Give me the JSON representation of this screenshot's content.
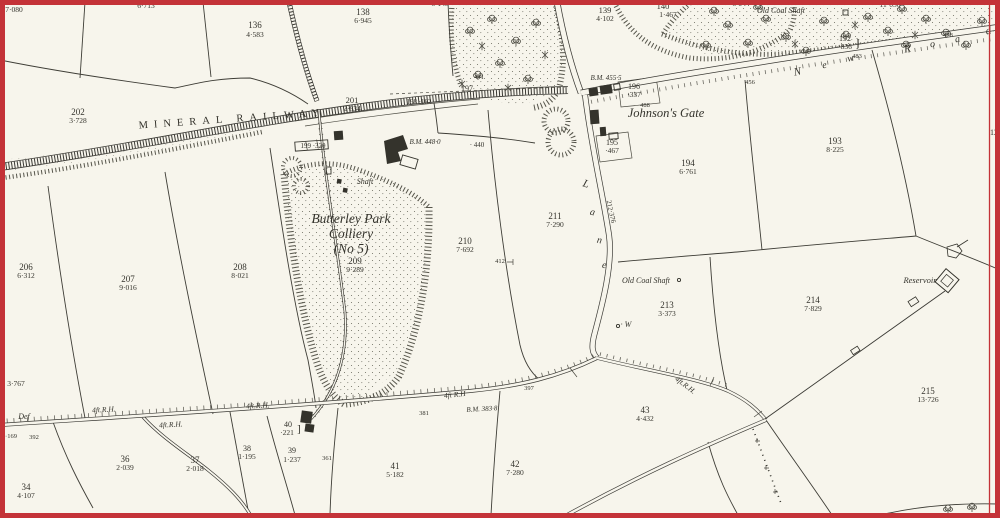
{
  "map": {
    "description": "Historical Ordnance Survey style plan, Butterley Park Colliery area",
    "palette": {
      "paper": "#f7f5ec",
      "ink": "#34332c",
      "frame_red": "#c43338"
    },
    "features": {
      "railway": "Mineral Railway with cross-hatched embankment and sidings",
      "colliery": "Butterley Park Colliery (No 5) with spoil heap and shafts",
      "roads": [
        "New Road",
        "Lane"
      ],
      "water": [
        "Reservoir"
      ],
      "boundary": "red sheet border"
    }
  },
  "labels": [
    {
      "t": "7·080",
      "x": 14,
      "y": 12,
      "s": 7.5,
      "st": "area"
    },
    {
      "t": "6·713",
      "x": 146,
      "y": 8,
      "s": 7.5,
      "st": "area"
    },
    {
      "t": "136",
      "x": 255,
      "y": 28,
      "s": 9,
      "st": "num"
    },
    {
      "t": "4·583",
      "x": 255,
      "y": 37,
      "s": 7.5,
      "st": "area"
    },
    {
      "t": "138",
      "x": 363,
      "y": 15,
      "s": 9,
      "st": "num"
    },
    {
      "t": "6·945",
      "x": 363,
      "y": 23,
      "s": 7.5,
      "st": "area"
    },
    {
      "t": "6·148",
      "x": 440,
      "y": 6,
      "s": 7.5,
      "st": "area"
    },
    {
      "t": "139",
      "x": 605,
      "y": 13,
      "s": 8.5,
      "st": "num"
    },
    {
      "t": "4·102",
      "x": 605,
      "y": 21,
      "s": 7.5,
      "st": "area"
    },
    {
      "t": "140",
      "x": 663,
      "y": 9,
      "s": 8.5,
      "st": "num"
    },
    {
      "t": "1·467",
      "x": 668,
      "y": 17,
      "s": 7.5,
      "st": "area"
    },
    {
      "t": "6·944",
      "x": 741,
      "y": 6,
      "s": 7.5,
      "st": "area"
    },
    {
      "t": "Old Coal Shaft",
      "x": 781,
      "y": 13,
      "s": 8,
      "st": "it"
    },
    {
      "t": "11·050",
      "x": 890,
      "y": 7,
      "s": 7.5,
      "st": "area"
    },
    {
      "t": "192",
      "x": 845,
      "y": 41,
      "s": 8,
      "st": "num"
    },
    {
      "t": "·836",
      "x": 845,
      "y": 49,
      "s": 7.5,
      "st": "area"
    },
    {
      "t": "}",
      "x": 858,
      "y": 47,
      "s": 13,
      "st": "num"
    },
    {
      "t": "478",
      "x": 948,
      "y": 37,
      "s": 6.5,
      "st": "tiny"
    },
    {
      "t": "N",
      "x": 798,
      "y": 75,
      "s": 11,
      "st": "it",
      "r": -10
    },
    {
      "t": "e",
      "x": 825,
      "y": 68,
      "s": 10,
      "st": "it",
      "r": -10
    },
    {
      "t": "w",
      "x": 851,
      "y": 61,
      "s": 10,
      "st": "it",
      "r": -10
    },
    {
      "t": "R",
      "x": 908,
      "y": 52,
      "s": 11,
      "st": "it",
      "r": -10
    },
    {
      "t": "o",
      "x": 933,
      "y": 47,
      "s": 10,
      "st": "it",
      "r": -10
    },
    {
      "t": "a",
      "x": 958,
      "y": 42,
      "s": 10,
      "st": "it",
      "r": -10
    },
    {
      "t": "d",
      "x": 989,
      "y": 34,
      "s": 11,
      "st": "it",
      "r": -10
    },
    {
      "t": "456",
      "x": 750,
      "y": 84,
      "s": 6.5,
      "st": "tiny"
    },
    {
      "t": "483",
      "x": 857,
      "y": 58,
      "s": 6.5,
      "st": "tiny"
    },
    {
      "t": "441",
      "x": 479,
      "y": 79,
      "s": 6.5,
      "st": "tiny"
    },
    {
      "t": "197",
      "x": 467,
      "y": 91,
      "s": 8,
      "st": "num"
    },
    {
      "t": "198 ·182",
      "x": 419,
      "y": 104,
      "s": 7,
      "st": "tiny"
    },
    {
      "t": "B.M. 455·5",
      "x": 606,
      "y": 80,
      "s": 7,
      "st": "bm"
    },
    {
      "t": "196",
      "x": 634,
      "y": 89,
      "s": 8,
      "st": "num"
    },
    {
      "t": "·337",
      "x": 634,
      "y": 97,
      "s": 7.5,
      "st": "area"
    },
    {
      "t": "488",
      "x": 645,
      "y": 107,
      "s": 6.5,
      "st": "tiny"
    },
    {
      "t": "Johnson's Gate",
      "x": 666,
      "y": 117,
      "s": 12.5,
      "st": "it"
    },
    {
      "t": "195",
      "x": 612,
      "y": 145,
      "s": 8,
      "st": "num"
    },
    {
      "t": "·467",
      "x": 612,
      "y": 153,
      "s": 7.5,
      "st": "area"
    },
    {
      "t": "12",
      "x": 994,
      "y": 135,
      "s": 8,
      "st": "num"
    },
    {
      "t": "193",
      "x": 835,
      "y": 144,
      "s": 9,
      "st": "num"
    },
    {
      "t": "8·225",
      "x": 835,
      "y": 152,
      "s": 7.5,
      "st": "area"
    },
    {
      "t": "194",
      "x": 688,
      "y": 166,
      "s": 9,
      "st": "num"
    },
    {
      "t": "6·761",
      "x": 688,
      "y": 174,
      "s": 7.5,
      "st": "area"
    },
    {
      "t": "MINERAL  RAILWAY",
      "x": 232,
      "y": 122,
      "s": 10.5,
      "st": "caps",
      "r": -4
    },
    {
      "t": "202",
      "x": 78,
      "y": 115,
      "s": 9,
      "st": "num"
    },
    {
      "t": "3·728",
      "x": 78,
      "y": 123,
      "s": 7.5,
      "st": "area"
    },
    {
      "t": "201",
      "x": 352,
      "y": 103,
      "s": 8.5,
      "st": "num"
    },
    {
      "t": "2·834",
      "x": 352,
      "y": 111,
      "s": 7.5,
      "st": "area"
    },
    {
      "t": "199 ·320",
      "x": 313,
      "y": 148,
      "s": 7,
      "st": "tiny"
    },
    {
      "t": "B.M. 448·0",
      "x": 425,
      "y": 144,
      "s": 7,
      "st": "bm"
    },
    {
      "t": "· 440",
      "x": 477,
      "y": 147,
      "s": 7,
      "st": "tiny"
    },
    {
      "t": "Shaft",
      "x": 365,
      "y": 184,
      "s": 8,
      "st": "it"
    },
    {
      "t": "Butterley Park",
      "x": 351,
      "y": 223,
      "s": 13.5,
      "st": "it"
    },
    {
      "t": "Colliery",
      "x": 351,
      "y": 238,
      "s": 13.5,
      "st": "it"
    },
    {
      "t": "(No 5)",
      "x": 351,
      "y": 253,
      "s": 13.5,
      "st": "it"
    },
    {
      "t": "209",
      "x": 355,
      "y": 264,
      "s": 9,
      "st": "num"
    },
    {
      "t": "9·289",
      "x": 355,
      "y": 272,
      "s": 7.5,
      "st": "area"
    },
    {
      "t": "210",
      "x": 465,
      "y": 244,
      "s": 9,
      "st": "num"
    },
    {
      "t": "7·692",
      "x": 465,
      "y": 252,
      "s": 7.5,
      "st": "area"
    },
    {
      "t": "412",
      "x": 500,
      "y": 263,
      "s": 6.5,
      "st": "tiny"
    },
    {
      "t": "211",
      "x": 555,
      "y": 219,
      "s": 9,
      "st": "num"
    },
    {
      "t": "7·290",
      "x": 555,
      "y": 227,
      "s": 7.5,
      "st": "area"
    },
    {
      "t": "L",
      "x": 585,
      "y": 187,
      "s": 11,
      "st": "it",
      "r": 18
    },
    {
      "t": "a",
      "x": 592,
      "y": 215,
      "s": 10,
      "st": "it",
      "r": 12
    },
    {
      "t": "n",
      "x": 599,
      "y": 243,
      "s": 10,
      "st": "it",
      "r": 10
    },
    {
      "t": "e",
      "x": 604,
      "y": 268,
      "s": 10,
      "st": "it",
      "r": 6
    },
    {
      "t": "212·376",
      "x": 609,
      "y": 212,
      "s": 7,
      "st": "tiny",
      "r": 78
    },
    {
      "t": "206",
      "x": 26,
      "y": 270,
      "s": 9,
      "st": "num"
    },
    {
      "t": "6·312",
      "x": 26,
      "y": 278,
      "s": 7.5,
      "st": "area"
    },
    {
      "t": "207",
      "x": 128,
      "y": 282,
      "s": 9,
      "st": "num"
    },
    {
      "t": "9·016",
      "x": 128,
      "y": 290,
      "s": 7.5,
      "st": "area"
    },
    {
      "t": "208",
      "x": 240,
      "y": 270,
      "s": 9,
      "st": "num"
    },
    {
      "t": "8·021",
      "x": 240,
      "y": 278,
      "s": 7.5,
      "st": "area"
    },
    {
      "t": "3·767",
      "x": 16,
      "y": 386,
      "s": 7.5,
      "st": "area"
    },
    {
      "t": "Old Coal Shaft",
      "x": 646,
      "y": 283,
      "s": 8,
      "st": "it"
    },
    {
      "t": "213",
      "x": 667,
      "y": 308,
      "s": 9,
      "st": "num"
    },
    {
      "t": "3·373",
      "x": 667,
      "y": 316,
      "s": 7.5,
      "st": "area"
    },
    {
      "t": "· W",
      "x": 626,
      "y": 327,
      "s": 8,
      "st": "it"
    },
    {
      "t": "214",
      "x": 813,
      "y": 303,
      "s": 9,
      "st": "num"
    },
    {
      "t": "7·829",
      "x": 813,
      "y": 311,
      "s": 7.5,
      "st": "area"
    },
    {
      "t": "Reservoir",
      "x": 920,
      "y": 283,
      "s": 8.5,
      "st": "it"
    },
    {
      "t": "215",
      "x": 928,
      "y": 394,
      "s": 9,
      "st": "num"
    },
    {
      "t": "13·726",
      "x": 928,
      "y": 402,
      "s": 7.5,
      "st": "area"
    },
    {
      "t": "43",
      "x": 645,
      "y": 413,
      "s": 9,
      "st": "num"
    },
    {
      "t": "4·432",
      "x": 645,
      "y": 421,
      "s": 7.5,
      "st": "area"
    },
    {
      "t": "4ft.R.H.",
      "x": 684,
      "y": 387,
      "s": 7.5,
      "st": "it",
      "r": 37
    },
    {
      "t": "42",
      "x": 515,
      "y": 467,
      "s": 9,
      "st": "num"
    },
    {
      "t": "7·280",
      "x": 515,
      "y": 475,
      "s": 7.5,
      "st": "area"
    },
    {
      "t": "41",
      "x": 395,
      "y": 469,
      "s": 9,
      "st": "num"
    },
    {
      "t": "5·182",
      "x": 395,
      "y": 477,
      "s": 7.5,
      "st": "area"
    },
    {
      "t": "B.M. 383·8",
      "x": 482,
      "y": 411,
      "s": 7,
      "st": "bm",
      "r": -3
    },
    {
      "t": "381",
      "x": 424,
      "y": 415,
      "s": 6.5,
      "st": "tiny"
    },
    {
      "t": "397",
      "x": 529,
      "y": 390,
      "s": 6.5,
      "st": "tiny"
    },
    {
      "t": "4ft R.H",
      "x": 455,
      "y": 397,
      "s": 7.5,
      "st": "it",
      "r": -6
    },
    {
      "t": "361",
      "x": 327,
      "y": 460,
      "s": 6.5,
      "st": "tiny"
    },
    {
      "t": "40",
      "x": 288,
      "y": 427,
      "s": 8,
      "st": "num"
    },
    {
      "t": "·221",
      "x": 287,
      "y": 435,
      "s": 7.5,
      "st": "area"
    },
    {
      "t": "]",
      "x": 299,
      "y": 432,
      "s": 11,
      "st": "num"
    },
    {
      "t": "39",
      "x": 292,
      "y": 453,
      "s": 8,
      "st": "num"
    },
    {
      "t": "1·237",
      "x": 292,
      "y": 462,
      "s": 7.5,
      "st": "area"
    },
    {
      "t": "38",
      "x": 247,
      "y": 451,
      "s": 8,
      "st": "num"
    },
    {
      "t": "1·195",
      "x": 247,
      "y": 459,
      "s": 7.5,
      "st": "area"
    },
    {
      "t": "37",
      "x": 195,
      "y": 463,
      "s": 9,
      "st": "num"
    },
    {
      "t": "2·018",
      "x": 195,
      "y": 471,
      "s": 7.5,
      "st": "area"
    },
    {
      "t": "36",
      "x": 125,
      "y": 462,
      "s": 9,
      "st": "num"
    },
    {
      "t": "2·039",
      "x": 125,
      "y": 470,
      "s": 7.5,
      "st": "area"
    },
    {
      "t": "34",
      "x": 26,
      "y": 490,
      "s": 9,
      "st": "num"
    },
    {
      "t": "4·107",
      "x": 26,
      "y": 498,
      "s": 7.5,
      "st": "area"
    },
    {
      "t": "Def",
      "x": 24,
      "y": 419,
      "s": 8,
      "st": "it"
    },
    {
      "t": "·169",
      "x": 11,
      "y": 438,
      "s": 6.5,
      "st": "tiny"
    },
    {
      "t": "392",
      "x": 34,
      "y": 439,
      "s": 6.5,
      "st": "tiny"
    },
    {
      "t": "4ft.R.H.",
      "x": 104,
      "y": 412,
      "s": 7.5,
      "st": "it",
      "r": -3
    },
    {
      "t": "4ft.R.H.",
      "x": 171,
      "y": 427,
      "s": 7.5,
      "st": "it",
      "r": -3
    },
    {
      "t": "4ft.R.H.",
      "x": 258,
      "y": 408,
      "s": 7.5,
      "st": "it",
      "r": -3
    }
  ]
}
